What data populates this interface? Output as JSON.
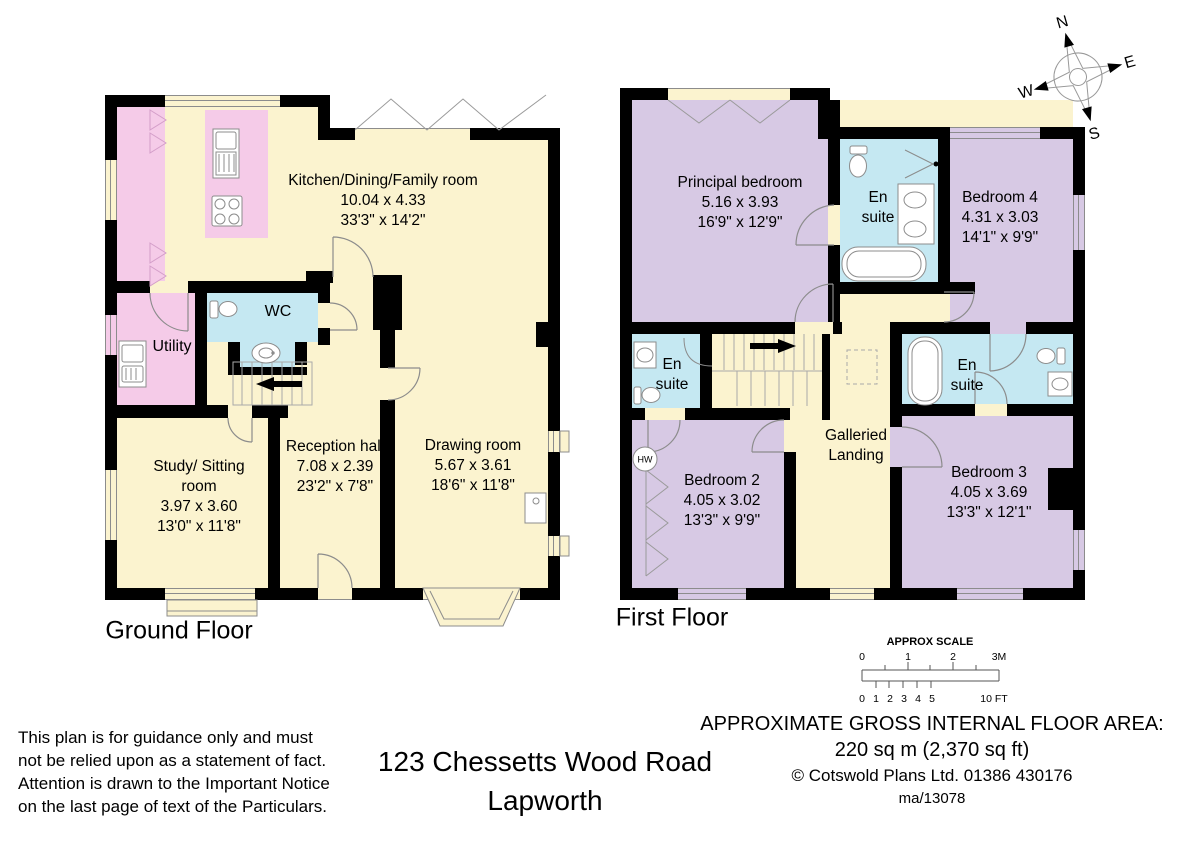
{
  "colors": {
    "wall": "#000000",
    "floor_cream": "#FBF3CF",
    "kitchen_pink": "#F5CBE8",
    "bathroom_blue": "#C5E8F2",
    "bedroom_purple": "#D7C9E4",
    "linework_gray": "#8c8c8c"
  },
  "compass": {
    "n": "N",
    "e": "E",
    "s": "S",
    "w": "W"
  },
  "ground_floor": {
    "label": "Ground Floor",
    "rooms": {
      "kitchen": {
        "name": "Kitchen/Dining/Family room",
        "metric": "10.04 x 4.33",
        "imperial": "33'3\" x 14'2\""
      },
      "wc": {
        "name": "WC"
      },
      "utility": {
        "name": "Utility"
      },
      "study": {
        "name": "Study/ Sitting room",
        "metric": "3.97 x 3.60",
        "imperial": "13'0\" x 11'8\""
      },
      "reception": {
        "name": "Reception hall",
        "metric": "7.08 x 2.39",
        "imperial": "23'2\" x 7'8\""
      },
      "drawing": {
        "name": "Drawing room",
        "metric": "5.67 x 3.61",
        "imperial": "18'6\" x 11'8\""
      }
    }
  },
  "first_floor": {
    "label": "First Floor",
    "rooms": {
      "principal": {
        "name": "Principal bedroom",
        "metric": "5.16 x 3.93",
        "imperial": "16'9\" x 12'9\""
      },
      "ensuite_principal": {
        "name": "En suite"
      },
      "bedroom4": {
        "name": "Bedroom 4",
        "metric": "4.31 x 3.03",
        "imperial": "14'1\" x 9'9\""
      },
      "ensuite_front": {
        "name": "En suite"
      },
      "bedroom2": {
        "name": "Bedroom 2",
        "metric": "4.05 x 3.02",
        "imperial": "13'3\" x 9'9\""
      },
      "landing": {
        "name": "Galleried Landing"
      },
      "bedroom3": {
        "name": "Bedroom 3",
        "metric": "4.05 x 3.69",
        "imperial": "13'3\" x 12'1\""
      },
      "ensuite_back": {
        "name": "En suite"
      },
      "hw": {
        "label": "HW"
      }
    }
  },
  "scale_bar": {
    "title": "APPROX SCALE",
    "metres": [
      "0",
      "1",
      "2",
      "3M"
    ],
    "feet": [
      "0",
      "1",
      "2",
      "3",
      "4",
      "5",
      "10 FT"
    ]
  },
  "footer": {
    "disclaimer_lines": [
      "This plan is for guidance only and must",
      "not be relied upon as a statement of fact.",
      "Attention is drawn to the Important Notice",
      "on the last page of text of the Particulars."
    ],
    "address_line1": "123 Chessetts Wood Road",
    "address_line2": "Lapworth",
    "area_heading": "APPROXIMATE GROSS INTERNAL FLOOR AREA:",
    "area_value": "220 sq m (2,370 sq ft)",
    "copyright": "©  Cotswold Plans Ltd. 01386 430176",
    "reference": "ma/13078"
  }
}
